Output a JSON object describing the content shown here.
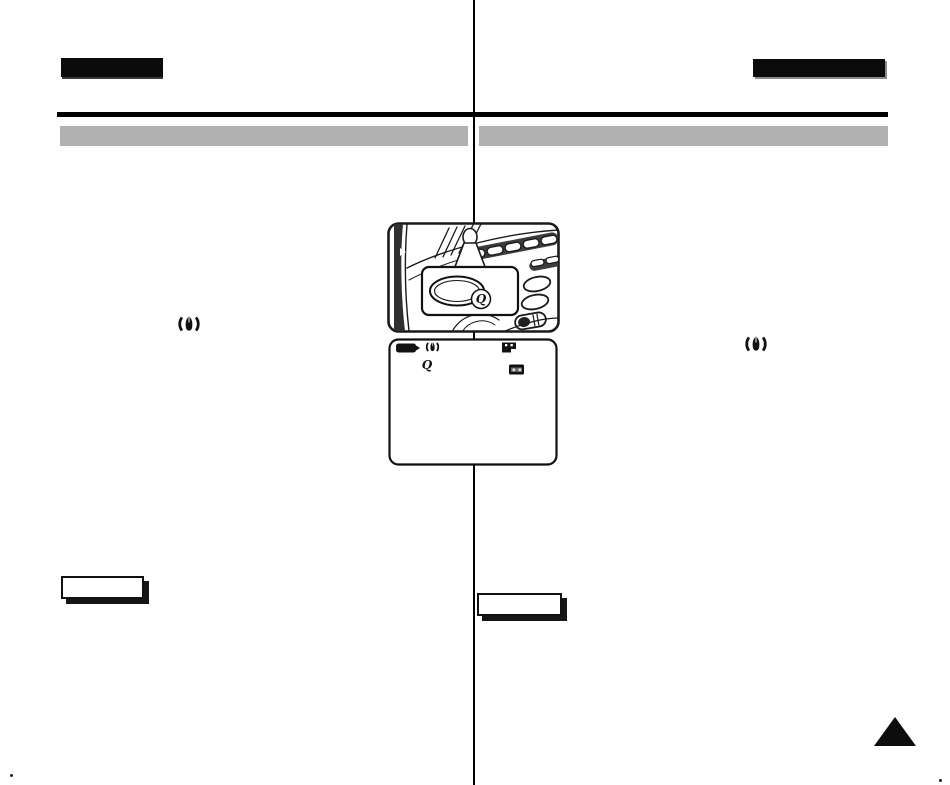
{
  "page": {
    "kind": "scanned-manual-page",
    "background": "#ffffff",
    "column_count": 2
  },
  "colors": {
    "tab_black": "#0b0b0b",
    "rule_black": "#000000",
    "section_gray": "#b1b1b1",
    "line_art_ink": "#1a1a1a"
  },
  "header": {
    "left_tab_label": "",
    "right_tab_label": ""
  },
  "section_bars": {
    "left_title": "",
    "right_title": ""
  },
  "illustration": {
    "name": "camcorder-side-panel-with-callout-button",
    "callout_button_glyph": "Q"
  },
  "osd": {
    "name": "lcd-osd-screen",
    "icon_names": [
      "battery-icon",
      "stabilizer-icon",
      "tape-end-icon",
      "pbzoom-icon",
      "cassette-icon"
    ],
    "pbzoom_glyph": "Q"
  },
  "margin_icons": {
    "left_column": "stabilizer-icon",
    "right_column": "stabilizer-icon"
  },
  "note_boxes": {
    "left_label": "",
    "right_label": ""
  },
  "footer": {
    "page_turn_marker": "triangle-up"
  }
}
